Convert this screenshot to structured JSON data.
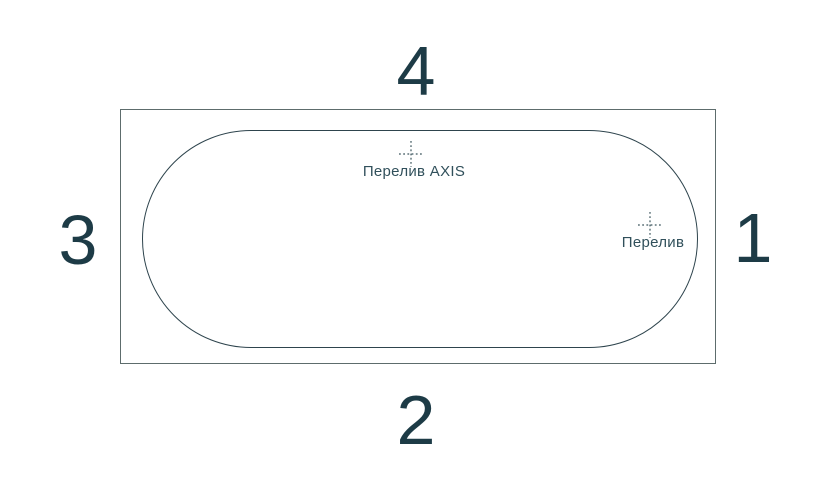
{
  "diagram": {
    "side_labels": {
      "top": "4",
      "right": "1",
      "bottom": "2",
      "left": "3"
    },
    "markers": [
      {
        "icon": "crosshair-icon",
        "label": "Перелив AXIS"
      },
      {
        "icon": "crosshair-icon",
        "label": "Перелив"
      }
    ],
    "colors": {
      "background": "#ffffff",
      "number_text": "#1d3b46",
      "label_text": "#31505b",
      "rim_line": "#5d6c6c",
      "basin_line": "#2e444d"
    }
  }
}
